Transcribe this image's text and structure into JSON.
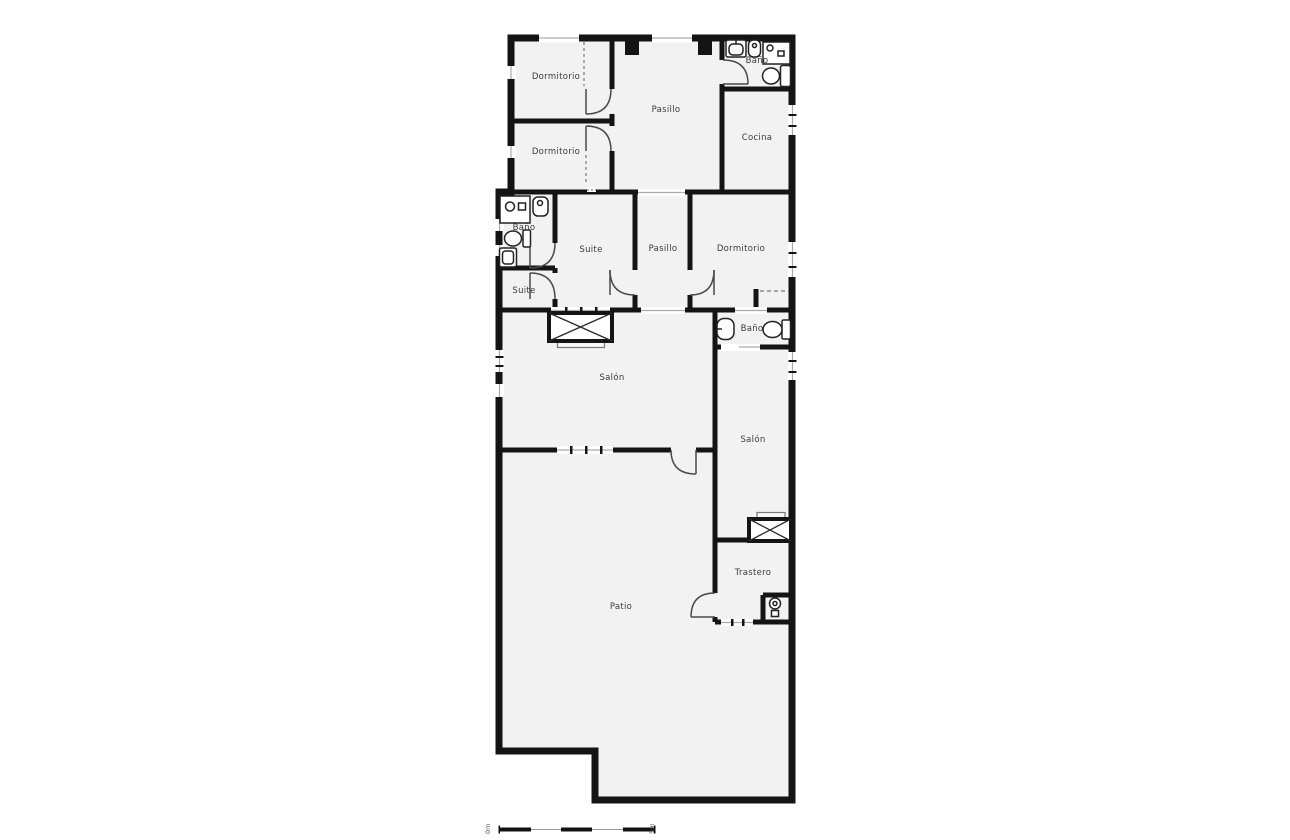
{
  "plan": {
    "rooms": [
      {
        "id": "dormitorio-1",
        "label": "Dormitorio"
      },
      {
        "id": "dormitorio-2",
        "label": "Dormitorio"
      },
      {
        "id": "pasillo-1",
        "label": "Pasillo"
      },
      {
        "id": "bano-1",
        "label": "Baño"
      },
      {
        "id": "cocina",
        "label": "Cocina"
      },
      {
        "id": "bano-2",
        "label": "Baño"
      },
      {
        "id": "suite-1",
        "label": "Suite"
      },
      {
        "id": "pasillo-2",
        "label": "Pasillo"
      },
      {
        "id": "dormitorio-3",
        "label": "Dormitorio"
      },
      {
        "id": "suite-2",
        "label": "Suite"
      },
      {
        "id": "salon-1",
        "label": "Salón"
      },
      {
        "id": "bano-3",
        "label": "Baño"
      },
      {
        "id": "salon-2",
        "label": "Salón"
      },
      {
        "id": "trastero",
        "label": "Trastero"
      },
      {
        "id": "patio",
        "label": "Patio"
      }
    ],
    "scale": {
      "start_label": "0m",
      "end_label": "5m",
      "segment_count": 5
    },
    "fixtures": [
      "sink-icon",
      "bidet-icon",
      "shower-icon",
      "toilet-icon",
      "washbasin-icon",
      "stairs-icon"
    ],
    "colors": {
      "wall": "#141414",
      "floor": "#f2f2f2",
      "background": "#ffffff",
      "door_line": "#4a4a4a",
      "window_line": "#aaaaaa"
    }
  }
}
